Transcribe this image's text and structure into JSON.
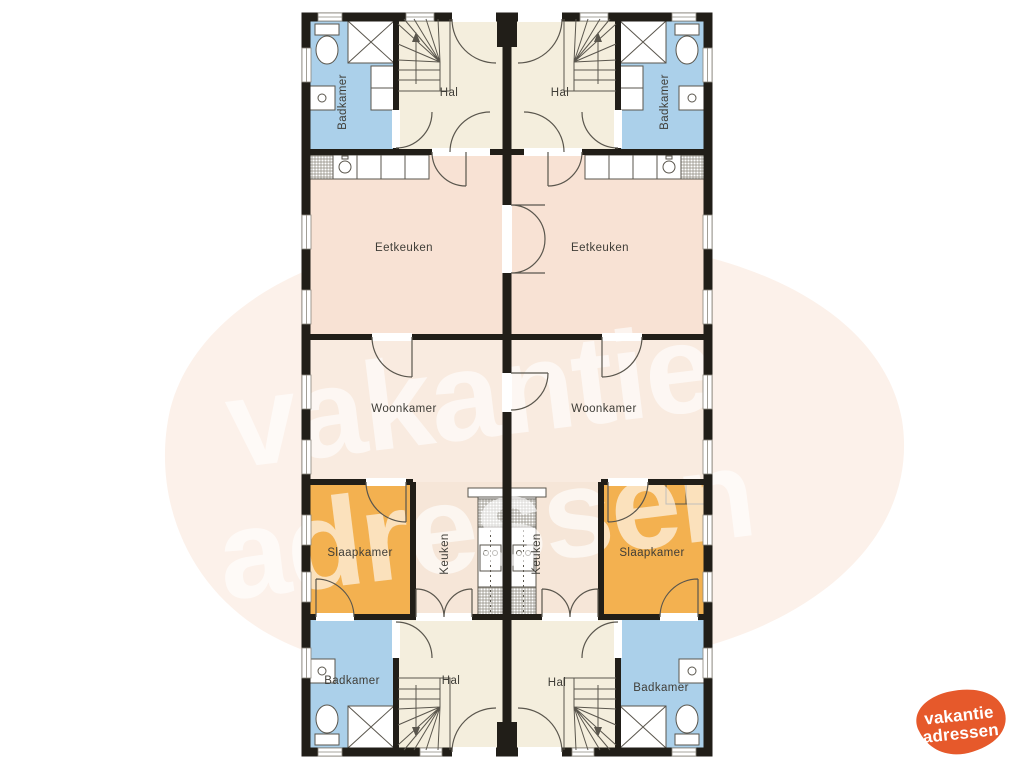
{
  "page": {
    "background": "#ffffff",
    "blob_color": "#fcf1ea"
  },
  "watermark": {
    "line1": "vakantie",
    "line2": "adressen",
    "color": "#ffffff"
  },
  "logo": {
    "line1": "vakantie",
    "line2": "adressen",
    "blob_color": "#e6592b",
    "text_color": "#ffffff"
  },
  "floorplan": {
    "room_labels": {
      "bathroom": "Badkamer",
      "hall": "Hal",
      "dining_kitchen": "Eetkeuken",
      "living_room": "Woonkamer",
      "bedroom": "Slaapkamer",
      "kitchen": "Keuken"
    },
    "colors": {
      "bathroom": "#abd0ea",
      "hall": "#f4eedd",
      "dining_kitchen": "#f8e2d4",
      "living_room": "#f9ebe0",
      "kitchen": "#f6e6d8",
      "bedroom": "#f3b150",
      "wall": "#211e18"
    }
  }
}
